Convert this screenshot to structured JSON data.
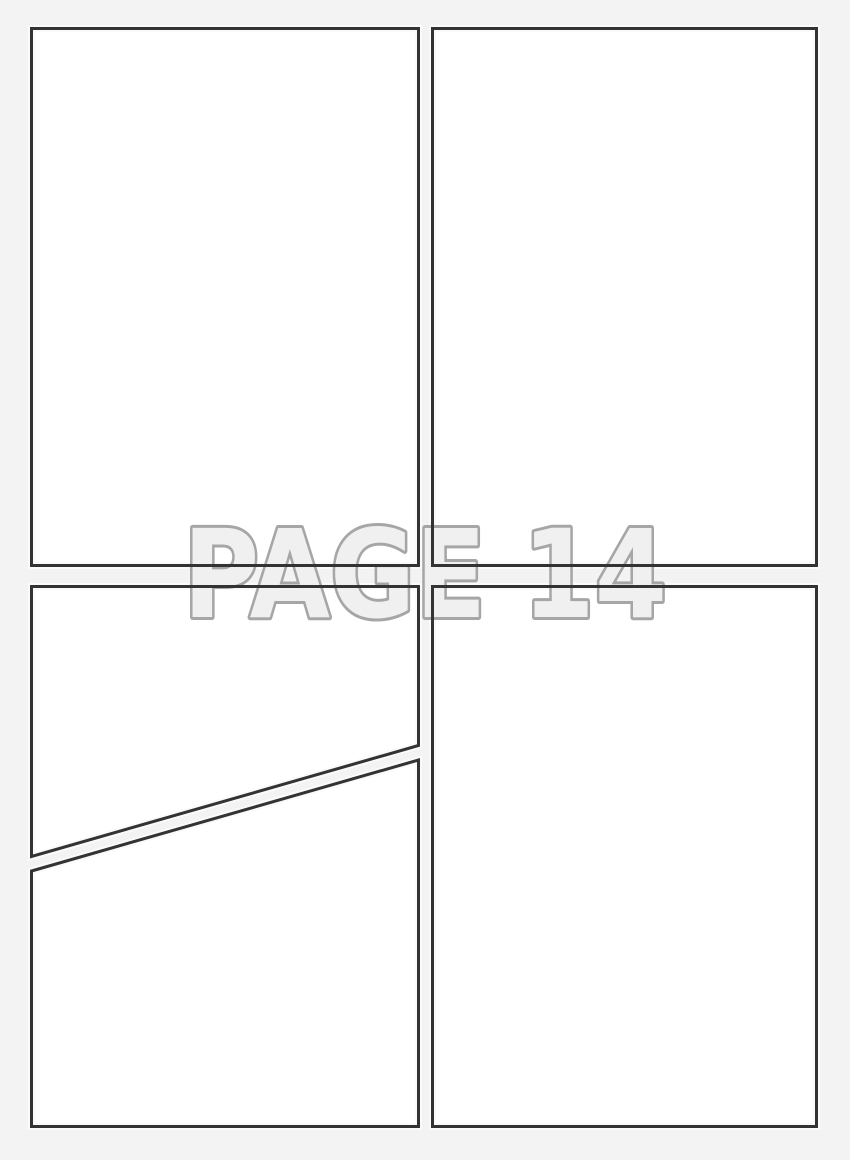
{
  "watermark": {
    "label": "PAGE 14",
    "fill_color": "#f0f0f0",
    "outline_color": "#a6a6a6"
  },
  "theme": {
    "background": "#f3f3f3",
    "panel_fill": "#ffffff",
    "panel_halo": "#fafafa",
    "panel_stroke": "#333333"
  },
  "panels": [
    {
      "id": "top-left",
      "content": ""
    },
    {
      "id": "top-right",
      "content": ""
    },
    {
      "id": "bottom-left-upper",
      "content": ""
    },
    {
      "id": "bottom-left-lower",
      "content": ""
    },
    {
      "id": "bottom-right",
      "content": ""
    }
  ]
}
